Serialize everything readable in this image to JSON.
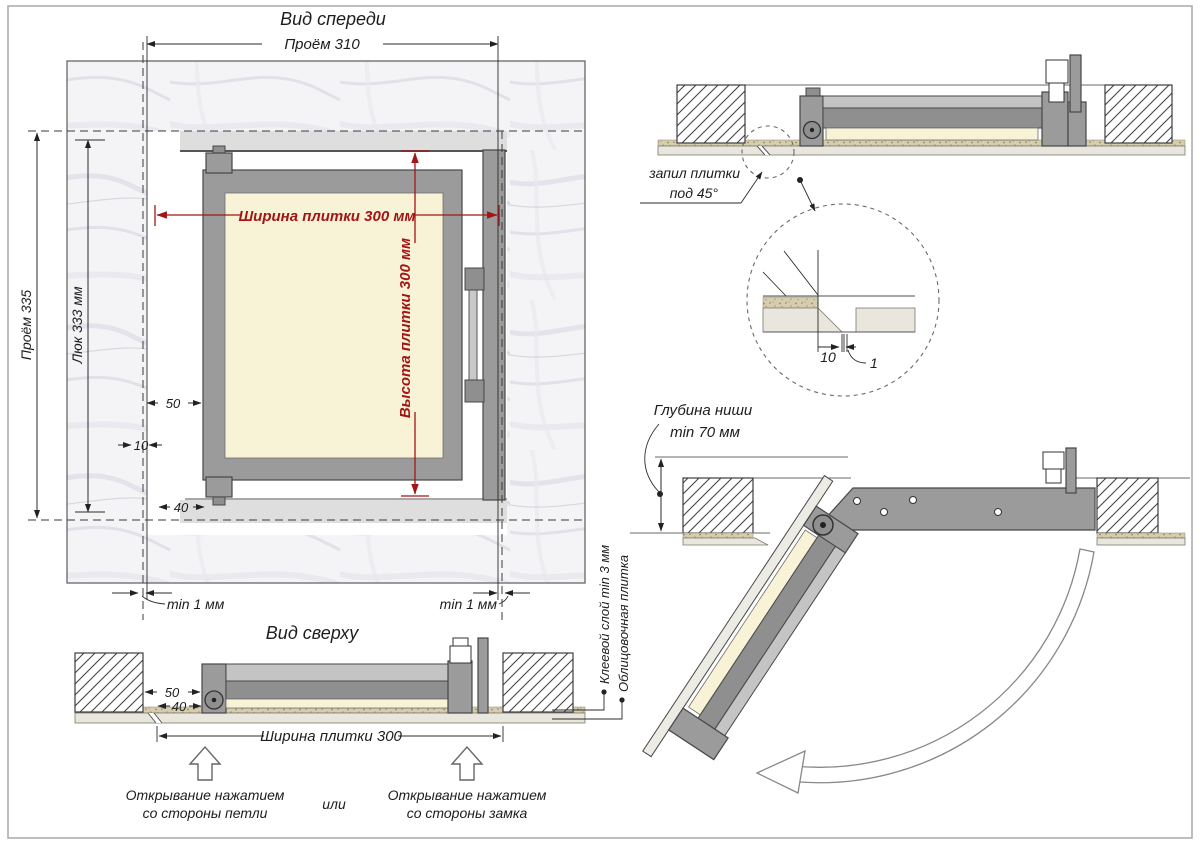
{
  "colors": {
    "dimension_red": "#a31515",
    "frame_gray": "#9b9b9b",
    "tile_cream": "#f8f3d7",
    "tile_layer": "#e8e6dd",
    "line_dark": "#2b2b2b"
  },
  "front_view": {
    "title": "Вид спереди",
    "dims": {
      "opening_w": "Проём 310",
      "opening_h": "Проём 335",
      "hatch_h": "Люк 333 мм",
      "tile_w": "Ширина плитки 300 мм",
      "tile_h": "Высота плитки 300 мм",
      "d50": "50",
      "d10": "10",
      "d40": "40",
      "gap_left": "min 1 мм",
      "gap_right": "min 1 мм"
    }
  },
  "top_view": {
    "title": "Вид сверху",
    "dims": {
      "d50": "50",
      "d40": "40",
      "tile_w": "Ширина плитки 300"
    },
    "labels": {
      "adhesive": "Клеевой слой min 3 мм",
      "tile": "Облицовочная плитка"
    },
    "captions": {
      "hinge_line1": "Открывание нажатием",
      "hinge_line2": "со стороны петли",
      "or": "или",
      "latch_line1": "Открывание нажатием",
      "latch_line2": "со стороны замка"
    }
  },
  "closed_section": {
    "labels": {
      "cut_line1": "запил плитки",
      "cut_line2": "под 45°"
    },
    "detail": {
      "d10": "10",
      "d1": "1"
    }
  },
  "open_section": {
    "labels": {
      "depth_line1": "Глубина ниши",
      "depth_line2": "min 70 мм"
    }
  }
}
